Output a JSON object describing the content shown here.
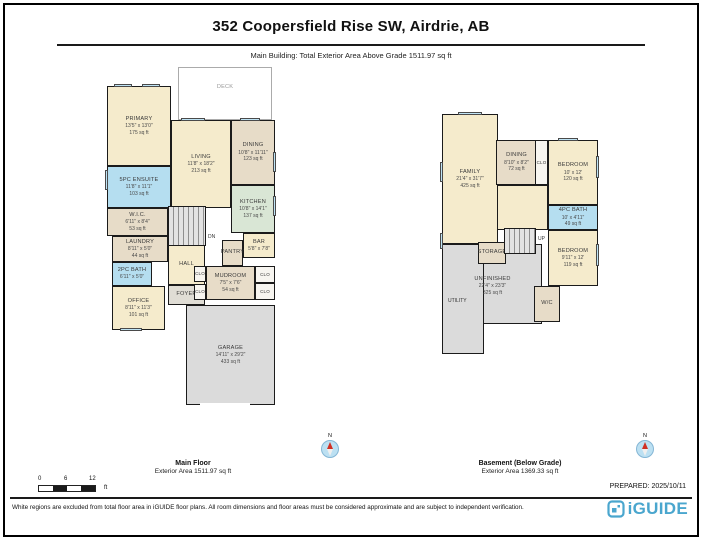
{
  "page": {
    "title": "352 Coopersfield Rise SW, Airdrie, AB",
    "subtitle": "Main Building: Total Exterior Area Above Grade 1511.97 sq ft",
    "prepared": "PREPARED: 2025/10/11",
    "disclaimer": "White regions are excluded from total floor area in iGUIDE floor plans. All room dimensions and floor areas must be considered approximate and are subject to independent verification.",
    "brand": "iGUIDE",
    "compass_label": "N",
    "accent_color": "#4AA6CE"
  },
  "scale_bar": {
    "tick0": "0",
    "tick1": "6",
    "tick2": "12",
    "unit": "ft"
  },
  "main_floor": {
    "caption_title": "Main Floor",
    "caption_area": "Exterior Area 1511.97 sq ft",
    "stair_label": "DN",
    "rooms": [
      {
        "name": "DECK",
        "dims": "",
        "area": ""
      },
      {
        "name": "PRIMARY",
        "dims": "13'5\" x 13'0\"",
        "area": "175 sq ft"
      },
      {
        "name": "5PC ENSUITE",
        "dims": "11'8\" x 11'1\"",
        "area": "103 sq ft"
      },
      {
        "name": "W.I.C.",
        "dims": "6'11\" x 8'4\"",
        "area": "53 sq ft"
      },
      {
        "name": "LAUNDRY",
        "dims": "8'11\" x 5'0\"",
        "area": "44 sq ft"
      },
      {
        "name": "2PC BATH",
        "dims": "6'11\" x 5'0\"",
        "area": ""
      },
      {
        "name": "OFFICE",
        "dims": "8'11\" x 11'3\"",
        "area": "101 sq ft"
      },
      {
        "name": "LIVING",
        "dims": "11'8\" x 18'2\"",
        "area": "213 sq ft"
      },
      {
        "name": "DINING",
        "dims": "10'8\" x 11'11\"",
        "area": "123 sq ft"
      },
      {
        "name": "KITCHEN",
        "dims": "10'8\" x 14'1\"",
        "area": "137 sq ft"
      },
      {
        "name": "BAR",
        "dims": "5'8\" x 7'8\"",
        "area": ""
      },
      {
        "name": "PANTRY",
        "dims": "",
        "area": ""
      },
      {
        "name": "MUDROOM",
        "dims": "7'5\" x 7'6\"",
        "area": "54 sq ft"
      },
      {
        "name": "HALL",
        "dims": "",
        "area": ""
      },
      {
        "name": "FOYER",
        "dims": "",
        "area": ""
      },
      {
        "name": "GARAGE",
        "dims": "14'11\" x 29'2\"",
        "area": "433 sq ft"
      },
      {
        "name": "CLO",
        "dims": "",
        "area": ""
      },
      {
        "name": "CLO",
        "dims": "",
        "area": ""
      },
      {
        "name": "CLO",
        "dims": "",
        "area": ""
      },
      {
        "name": "CLO",
        "dims": "",
        "area": ""
      }
    ]
  },
  "basement": {
    "caption_title": "Basement (Below Grade)",
    "caption_area": "Exterior Area 1369.33 sq ft",
    "stair_label": "UP",
    "rooms": [
      {
        "name": "FAMILY",
        "dims": "21'4\" x 31'7\"",
        "area": "425 sq ft"
      },
      {
        "name": "DINING",
        "dims": "8'10\" x 8'2\"",
        "area": "72 sq ft"
      },
      {
        "name": "CLO",
        "dims": "",
        "area": ""
      },
      {
        "name": "BEDROOM",
        "dims": "10' x 12'",
        "area": "120 sq ft"
      },
      {
        "name": "4PC BATH",
        "dims": "10' x 4'11\"",
        "area": "49 sq ft"
      },
      {
        "name": "BEDROOM",
        "dims": "9'11\" x 12'",
        "area": "119 sq ft"
      },
      {
        "name": "STORAGE",
        "dims": "",
        "area": ""
      },
      {
        "name": "UNFINISHED",
        "dims": "22'4\" x 23'3\"",
        "area": "325 sq ft"
      },
      {
        "name": "UTILITY",
        "dims": "",
        "area": ""
      },
      {
        "name": "W/C",
        "dims": "",
        "area": ""
      }
    ]
  }
}
